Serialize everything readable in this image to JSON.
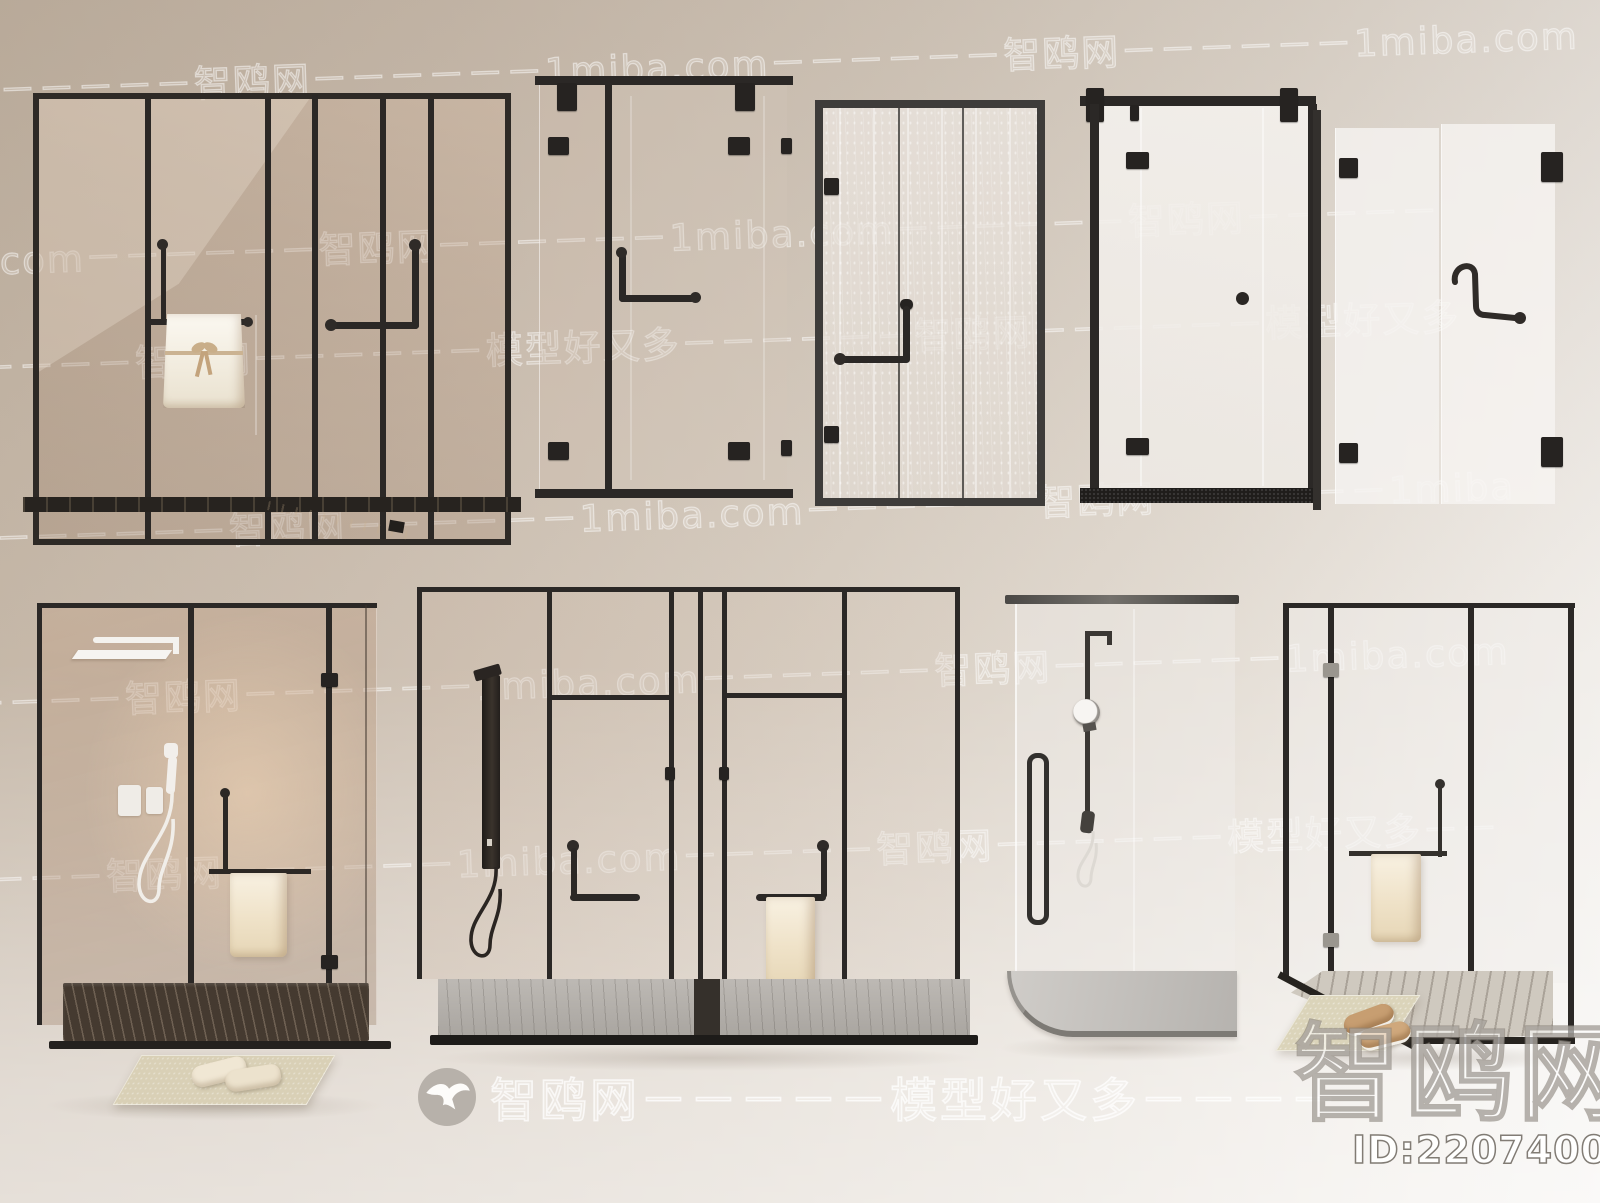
{
  "scene": {
    "description": "Nine glass shower door and shower enclosure 3D models displayed on a beige studio background",
    "top_row_count": 5,
    "bottom_row_count": 4
  },
  "watermarks": {
    "brand": "智鸥网",
    "site": "1miba.com",
    "slogan": "模型好又多",
    "rows": [
      "－－－－－－智鸥网－－－－－－1miba.com－－－－－－智鸥网－－－－－－1miba.com",
      "1miba.com－－－－－－智鸥网－－－－－－1miba.com－－－－－－智鸥网－－－－－",
      "－－－－－智鸥网－－－－－－模型好又多－－－－－－智鸥网－－－－－－模型好又多",
      "com－－－－－－智鸥网－－－－－－1miba.com－－－－－－智鸥网－－－－－－1miba",
      "－－－－－智鸥网－－－－－－1miba.com－－－－－－智鸥网－－－－－－1miba.com",
      "－－－－智鸥网－－－－－－1miba.com－－－－－智鸥网－－－－－－模型好又多－－"
    ],
    "footer_center": "智鸥网－－－－－模型好又多－－－－",
    "footer_logo": "seagull-logo",
    "big_brand": "智鸥网",
    "model_id": "ID:220740088"
  },
  "colors": {
    "frame_black": "#2b2826",
    "frame_gray": "#3e3c3a",
    "glass_warm_tint": "rgba(180,150,125,0.35)",
    "towel_cream": "#f2e7d2",
    "tray_dark_wood": "#453a30",
    "tray_gray_marble": "#b5b1ac",
    "background_top_left": "#c3b5a5",
    "background_bottom_right": "#f4f2ef"
  }
}
